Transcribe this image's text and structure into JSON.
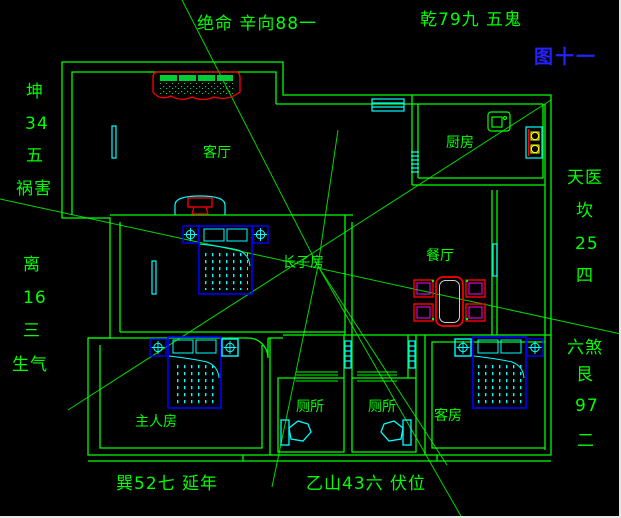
{
  "figure_label": "图十一",
  "compass": {
    "top_left": "绝命 辛向88一",
    "top_right": "乾79九 五鬼",
    "left_upper": [
      "坤",
      "34",
      "五",
      "祸害"
    ],
    "left_lower": [
      "离",
      "16",
      "三",
      "生气"
    ],
    "right_upper": [
      "天医",
      "坎",
      "25",
      "四"
    ],
    "right_lower": [
      "六煞",
      "艮",
      "97",
      "二"
    ],
    "bottom_left": "巽52七 延年",
    "bottom_center": "乙山43六 伏位"
  },
  "rooms": {
    "living_room": "客厅",
    "kitchen": "厨房",
    "dining_room": "餐厅",
    "eldest_son_room": "长子房",
    "master_bedroom": "主人房",
    "toilet_left": "厕所",
    "toilet_right": "厕所",
    "guest_room": "客房"
  },
  "colors": {
    "background": "#000000",
    "line_green": "#00ff00",
    "cyan": "#00ffff",
    "blue": "#0000ff",
    "red": "#ff0000",
    "magenta": "#ff00ff",
    "yellow": "#ffff00",
    "figure_blue": "#2323ff"
  }
}
